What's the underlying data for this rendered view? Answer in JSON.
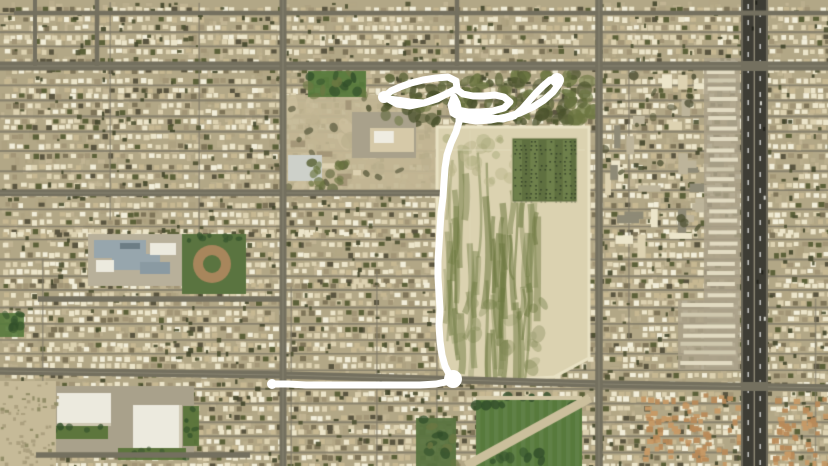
{
  "scene": {
    "description": "aerial-satellite-view-with-drawn-route",
    "width": 828,
    "height": 466
  },
  "palette": {
    "base": "#b2a786",
    "groundVariants": [
      "#c2b694",
      "#b4a884",
      "#a99d7c",
      "#cfc2a0"
    ],
    "houseColors": [
      "#ece5ca",
      "#f2eeda",
      "#ddd2b1",
      "#c7b892",
      "#a29576",
      "#7e7458",
      "#5a5540",
      "#5c6139"
    ],
    "houseWeights": [
      0.26,
      0.13,
      0.2,
      0.12,
      0.08,
      0.06,
      0.07,
      0.08
    ],
    "treeDark1": "#4f5233",
    "treeDark2": "#44472c",
    "street": "#827c6a",
    "roadMajor": "#74705f",
    "roadLane": "#96917d",
    "highway": "#3e3d35",
    "highwayEdge": "#6b6758",
    "highwayMedian": "#8e8a76",
    "lotSand": "#dbd2b0",
    "lotBorder": "#e9e2c4",
    "lotGreen": "#6e7a42",
    "beltGreen1": "#5a6337",
    "beltGreen2": "#6c7742",
    "beltGreen3": "#49512c",
    "orchardBase": "#5f7040",
    "orchardStripe": "#72844d",
    "orchardDot": "#36432a",
    "parkGreen": "#577a3c",
    "parkTree": "#33502b",
    "fieldGreen": "#5a7440",
    "diamondBrown": "#a8865c",
    "schoolPad": "#b8b09a",
    "schoolRoof": "#97a6ad",
    "whiteRoof": "#eceade",
    "parkingGray": "#a9a18b",
    "sandSparse": "#c3b795",
    "desertSand": "#c6ba98",
    "desertDot": "#a89d7c",
    "orangeRoof1": "#c79a66",
    "orangeRoof2": "#b98a58",
    "lawnGreen": "#597439",
    "pathBand": "#cbbf9c",
    "annotation": "#ffffff"
  },
  "texture": {
    "groundSpeckleCount": 3000,
    "treeSpeckleCount": 750,
    "rowSpacingMin": 12.5,
    "rowSpacingVar": 8,
    "houseStepMin": 6,
    "houseStepVar": 2.5,
    "vStreetSpacingMin": 44,
    "vStreetSpacingVar": 72,
    "seed": 42
  },
  "roads": {
    "horizontal": [
      {
        "y": 13,
        "x1": 14,
        "x2": 828,
        "w": 4.5
      },
      {
        "y": 66,
        "x1": 0,
        "x2": 828,
        "w": 9
      },
      {
        "y": 193,
        "x1": 0,
        "x2": 440,
        "w": 6.5
      },
      {
        "y": 299,
        "x1": 38,
        "x2": 285,
        "w": 5.5
      },
      {
        "y": 455,
        "x1": 36,
        "x2": 250,
        "w": 5.5
      }
    ],
    "main_south_polyline": {
      "points": [
        [
          0,
          371
        ],
        [
          283,
          375
        ],
        [
          460,
          380
        ],
        [
          599,
          384
        ],
        [
          828,
          388
        ]
      ],
      "w": 7.5
    },
    "vertical": [
      {
        "x": 35,
        "y1": 0,
        "y2": 66,
        "w": 4
      },
      {
        "x": 97,
        "y1": 0,
        "y2": 66,
        "w": 4.5
      },
      {
        "x": 283,
        "y1": 0,
        "y2": 466,
        "w": 7
      },
      {
        "x": 457,
        "y1": 0,
        "y2": 66,
        "w": 4.5
      },
      {
        "x": 599,
        "y1": 0,
        "y2": 466,
        "w": 7.5
      }
    ],
    "highway": {
      "x": 741,
      "width": 27,
      "medianX": 753.6,
      "dashLanes": [
        747.5,
        759.5
      ],
      "dashStep": 16
    }
  },
  "regions": {
    "sparse_zone": [
      285,
      95,
      152,
      98
    ],
    "apartments_ne": [
      604,
      72,
      138,
      168
    ],
    "apartments_hwy_west": [
      704,
      58,
      36,
      312
    ],
    "apartments_mid_east": [
      678,
      300,
      60,
      70
    ],
    "commercial_parking": [
      352,
      112,
      64,
      46
    ],
    "commercial_building1": [
      370,
      128,
      44,
      24
    ],
    "commercial_building2": [
      288,
      155,
      34,
      26
    ],
    "commercial_trees": [
      308,
      162,
      40,
      28
    ],
    "green_belt": [
      385,
      74,
      210,
      48
    ],
    "park_ne_small": [
      308,
      71,
      58,
      26
    ],
    "dirt_lot_polygon": [
      [
        437,
        127
      ],
      [
        589,
        127
      ],
      [
        589,
        358
      ],
      [
        554,
        377
      ],
      [
        462,
        383
      ],
      [
        441,
        367
      ],
      [
        437,
        318
      ]
    ],
    "orchard": [
      512,
      138,
      65,
      64
    ],
    "school_pad": [
      88,
      234,
      104,
      52
    ],
    "ballfield": [
      182,
      234,
      64,
      60
    ],
    "retail_sw_parking": [
      46,
      386,
      148,
      68
    ],
    "store1": [
      57,
      393,
      54,
      33
    ],
    "store2": [
      133,
      405,
      49,
      43
    ],
    "lawn1": [
      50,
      426,
      58,
      13
    ],
    "lawn2": [
      118,
      448,
      68,
      12
    ],
    "lawn3": [
      183,
      406,
      16,
      40
    ],
    "park_bottom": [
      476,
      396,
      106,
      70
    ],
    "park_small": [
      416,
      418,
      40,
      48
    ],
    "desert_sw": [
      0,
      381,
      56,
      85
    ],
    "green_left_edge": [
      0,
      313,
      24,
      24
    ],
    "orange_district_1": [
      640,
      392,
      100,
      74
    ],
    "orange_district_2": [
      770,
      396,
      58,
      70
    ]
  },
  "annotation": {
    "color": "#ffffff",
    "stroke_width": 7,
    "path_points": [
      [
        384,
        97
      ],
      [
        391,
        91
      ],
      [
        400,
        87
      ],
      [
        411,
        83
      ],
      [
        423,
        80
      ],
      [
        436,
        78
      ],
      [
        448,
        77
      ],
      [
        456,
        81
      ],
      [
        457,
        88
      ],
      [
        449,
        93
      ],
      [
        437,
        98
      ],
      [
        424,
        103
      ],
      [
        410,
        106
      ],
      [
        397,
        104
      ],
      [
        388,
        99
      ],
      [
        397,
        100
      ],
      [
        410,
        102
      ],
      [
        424,
        103
      ],
      [
        437,
        99
      ],
      [
        448,
        93
      ],
      [
        456,
        89
      ],
      [
        463,
        94
      ],
      [
        473,
        96
      ],
      [
        484,
        96
      ],
      [
        495,
        95
      ],
      [
        504,
        97
      ],
      [
        510,
        102
      ],
      [
        504,
        108
      ],
      [
        493,
        111
      ],
      [
        480,
        112
      ],
      [
        468,
        112
      ],
      [
        458,
        110
      ],
      [
        464,
        113
      ],
      [
        476,
        116
      ],
      [
        490,
        118
      ],
      [
        503,
        119
      ],
      [
        514,
        116
      ],
      [
        522,
        109
      ],
      [
        529,
        101
      ],
      [
        536,
        93
      ],
      [
        543,
        86
      ],
      [
        550,
        80
      ],
      [
        557,
        78
      ],
      [
        559,
        84
      ],
      [
        553,
        92
      ],
      [
        544,
        100
      ],
      [
        533,
        107
      ],
      [
        520,
        113
      ],
      [
        506,
        117
      ],
      [
        491,
        120
      ],
      [
        476,
        121
      ],
      [
        463,
        119
      ],
      [
        453,
        113
      ],
      [
        451,
        105
      ],
      [
        454,
        97
      ],
      [
        457,
        103
      ],
      [
        459,
        112
      ],
      [
        459,
        122
      ],
      [
        456,
        132
      ],
      [
        451,
        143
      ],
      [
        447,
        155
      ],
      [
        445,
        168
      ],
      [
        444,
        182
      ],
      [
        443,
        197
      ],
      [
        441,
        213
      ],
      [
        440,
        229
      ],
      [
        439,
        245
      ],
      [
        438,
        261
      ],
      [
        438,
        277
      ],
      [
        439,
        293
      ],
      [
        440,
        309
      ],
      [
        439,
        325
      ],
      [
        440,
        341
      ],
      [
        442,
        355
      ],
      [
        445,
        366
      ],
      [
        449,
        374
      ],
      [
        453,
        379
      ],
      [
        446,
        382
      ],
      [
        436,
        384
      ],
      [
        420,
        385
      ],
      [
        400,
        385
      ],
      [
        378,
        385
      ],
      [
        354,
        385
      ],
      [
        330,
        385
      ],
      [
        306,
        385
      ],
      [
        288,
        384
      ],
      [
        272,
        384
      ]
    ],
    "blobs": [
      {
        "x": 384,
        "y": 97,
        "r": 6
      },
      {
        "x": 557,
        "y": 80,
        "r": 7
      },
      {
        "x": 453,
        "y": 379,
        "r": 9
      },
      {
        "x": 272,
        "y": 384,
        "r": 5
      }
    ]
  }
}
